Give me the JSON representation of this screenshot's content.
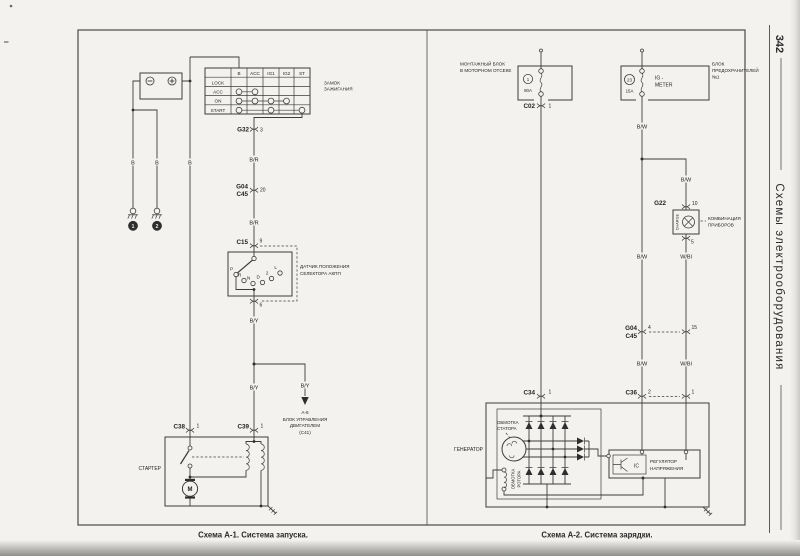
{
  "page": {
    "number": "342",
    "side_title": "Схемы электрооборудования",
    "caption_a1": "Схема А-1. Система запуска.",
    "caption_a2": "Схема А-2. Система зарядки."
  },
  "a1": {
    "wires": {
      "b1": "B",
      "b2": "B",
      "b3": "B",
      "br1": "B/R",
      "br2": "B/R",
      "by1": "B/Y",
      "by2": "B/Y",
      "by3": "B/Y"
    },
    "grounds": {
      "g1": "1",
      "g2": "2"
    },
    "ignition": {
      "headers": [
        "B",
        "ACC",
        "IG1",
        "IG2",
        "ST"
      ],
      "rows": [
        "LOCK",
        "ACC",
        "ON",
        "START"
      ],
      "label1": "ЗАМОК",
      "label2": "ЗАЖИГАНИЯ"
    },
    "conn": {
      "g32": "G32",
      "g32_pin": "3",
      "g04": "G04",
      "c45": "C45",
      "g04_pin": "20",
      "c15": "C15",
      "c15_pin_top": "9",
      "c15_pin_bot": "6",
      "c38": "C38",
      "c38_pin": "1",
      "c39": "C39",
      "c39_pin": "1"
    },
    "selector": {
      "pos": [
        "P",
        "R",
        "N",
        "D",
        "2",
        "L"
      ],
      "label1": "ДАТЧИК ПОЛОЖЕНИЯ",
      "label2": "СЕЛЕКТОРА АКПП"
    },
    "ecu": {
      "l1": "А-6",
      "l2": "БЛОК УПРАВЛЕНИЯ",
      "l3": "ДВИГАТЕЛЕМ",
      "l4": "(С41)"
    },
    "starter": {
      "label": "СТАРТЕР",
      "motor": "M"
    }
  },
  "a2": {
    "wires": {
      "bw1": "B/W",
      "bw2": "B/W",
      "bw3": "B/W",
      "bw4": "B/W",
      "wbl1": "W/Bl",
      "wbl2": "W/Bl"
    },
    "mount": {
      "l1": "МОНТАЖНЫЙ БЛОК",
      "l2": "В МОТОРНОМ ОТСЕКЕ",
      "fuse": "1",
      "amp": "80A"
    },
    "fusebox": {
      "l1": "БЛОК",
      "l2": "ПРЕДОХРАНИТЕЛЕЙ",
      "l3": "№1",
      "fuse": "23",
      "amp": "15A",
      "cir1": "IG -",
      "cir2": "METER"
    },
    "conn": {
      "c02": "C02",
      "c02_pin": "1",
      "c34": "C34",
      "c34_pin": "1",
      "g22": "G22",
      "g22_top": "10",
      "g22_bot": "5",
      "g04": "G04",
      "c45": "C45",
      "p4": "4",
      "p15": "15",
      "c36": "C36",
      "p2": "2",
      "p1": "1"
    },
    "cluster": {
      "lamp": "CHARGE",
      "l1": "КОМБИНАЦИЯ",
      "l2": "ПРИБОРОВ"
    },
    "gen": {
      "label": "ГЕНЕРАТОР",
      "st1": "ОБМОТКА",
      "st2": "СТАТОРА",
      "rt1": "ОБМОТКА",
      "rt2": "РОТОРА",
      "ic": "IC",
      "reg1": "РЕГУЛЯТОР",
      "reg2": "НАПРЯЖЕНИЯ"
    }
  }
}
